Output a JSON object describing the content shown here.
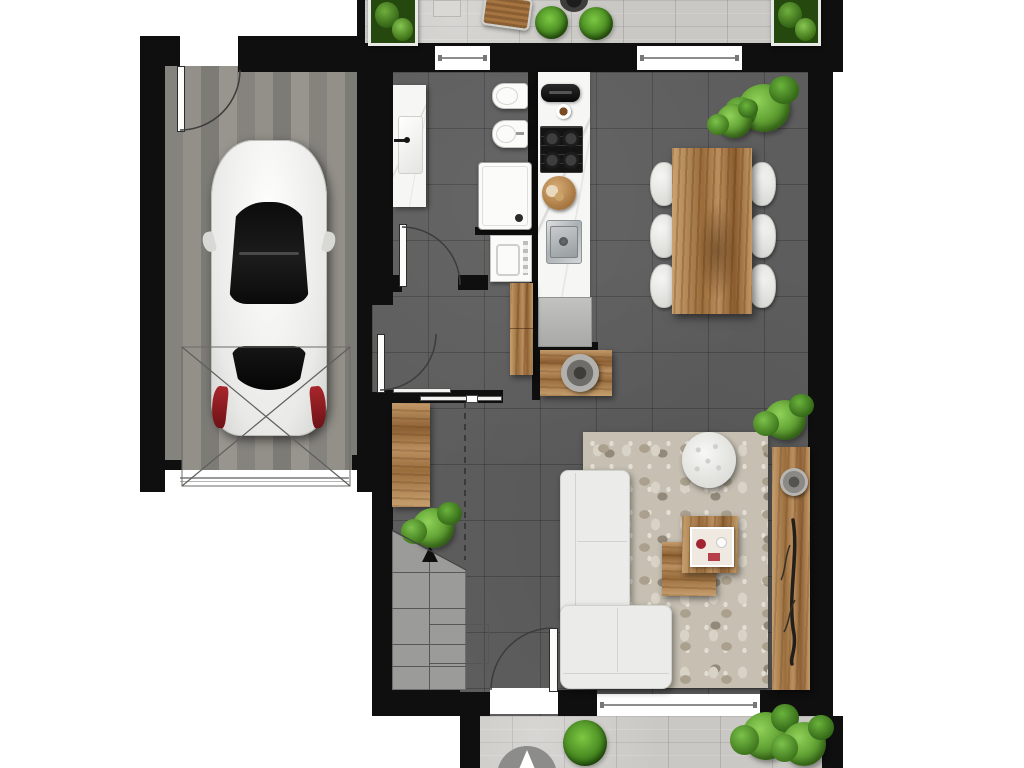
{
  "title": "residential-floor-plan-render",
  "view": "top-down",
  "palette": {
    "background": "#ffffff",
    "wall": "#0f0f0f",
    "interior_floor": "#5d5d5d",
    "garage_pavers": "#8d8b86",
    "terrace_stone": "#c9c8c4",
    "wood": "#b08a5a",
    "kitchen_counter": "#f6f6f4",
    "sofa": "#ebebe9",
    "rug": "#c6bfb2",
    "plant_green": "#5ba832",
    "taillight_red": "#8f2026",
    "compass_gray": "#8c8c8a"
  },
  "areas": {
    "terrace_top": {
      "items": [
        "planter-box",
        "stone-pad",
        "wood-lounger",
        "fire-bowl",
        "round-bush",
        "round-bush",
        "planter-box"
      ]
    },
    "garage": {
      "items": [
        "white-car-top-view",
        "garage-door-cross-marking",
        "pedestrian-door"
      ]
    },
    "bathroom": {
      "items": [
        "vanity-with-basin",
        "toilet",
        "bidet",
        "shower-tray",
        "washing-machine"
      ]
    },
    "kitchen": {
      "items": [
        "coffee-machine",
        "espresso-cup",
        "gas-hob-4-burners",
        "round-cutting-board",
        "inset-sink",
        "base-cabinet"
      ]
    },
    "dining": {
      "items": [
        "wood-table",
        "chairs-x6",
        "plant"
      ]
    },
    "living": {
      "items": [
        "l-shaped-sofa",
        "area-rug",
        "round-tufted-pouf",
        "nesting-coffee-tables",
        "serving-tray",
        "wood-sideboard",
        "decor-bowl",
        "decor-branch",
        "plant"
      ]
    },
    "hall": {
      "items": [
        "wardrobe-cabinet",
        "console-table",
        "decor-bowl",
        "wall-desk",
        "plant",
        "staircase-up",
        "sliding-door",
        "dashed-headroom-line"
      ]
    },
    "terrace_bottom": {
      "items": [
        "north-compass-arrow",
        "round-bush",
        "bush-cluster"
      ]
    }
  },
  "counts": {
    "door_swings": 4,
    "sliding_doors": 1,
    "windows": 3,
    "dining_chairs": 6,
    "plants_and_bushes": 10,
    "stair_treads": 5
  },
  "icons": {
    "north_arrow": "compass arrow pointing up",
    "stair_direction": "black triangle arrow pointing up"
  }
}
